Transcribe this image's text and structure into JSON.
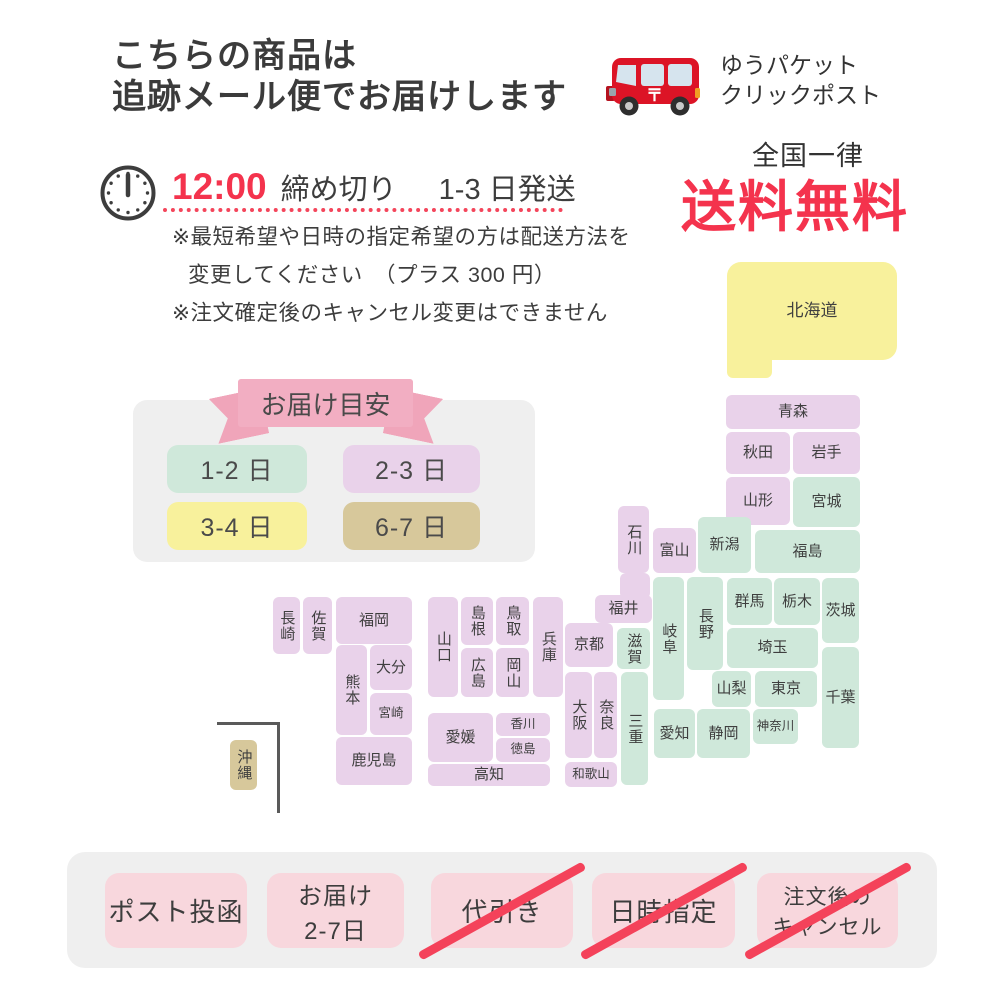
{
  "header": {
    "title_line1": "こちらの商品は",
    "title_line2": "追跡メール便でお届けします",
    "service_line1": "ゆうパケット",
    "service_line2": "クリックポスト",
    "nationwide": "全国一律",
    "free_shipping": "送料無料",
    "accent_red": "#f4334d"
  },
  "deadline": {
    "time": "12:00",
    "label": "締め切り",
    "ship": "1-3 日発送",
    "note1": "※最短希望や日時の指定希望の方は配送方法を",
    "note2": "変更してください　（プラス 300 円）",
    "note3": "※注文確定後のキャンセル変更はできません"
  },
  "legend": {
    "title": "お届け目安",
    "items": [
      {
        "label": "1-2 日",
        "color": "#cfe8da"
      },
      {
        "label": "2-3 日",
        "color": "#e9d2ea"
      },
      {
        "label": "3-4 日",
        "color": "#f8f19c"
      },
      {
        "label": "6-7 日",
        "color": "#d7c89b"
      }
    ]
  },
  "map": {
    "palette": {
      "green": "#cfe8da",
      "purple": "#e9d2ea",
      "yellow": "#f8f19c",
      "tan": "#d7c89b"
    },
    "prefectures": [
      {
        "id": "hokkaido",
        "name": "北海道",
        "days": "3-4",
        "color": "yellow",
        "x": 727,
        "y": 262,
        "w": 170,
        "h": 98,
        "big": true
      },
      {
        "id": "aomori",
        "name": "青森",
        "days": "2-3",
        "color": "purple",
        "x": 726,
        "y": 395,
        "w": 134,
        "h": 34
      },
      {
        "id": "akita",
        "name": "秋田",
        "days": "2-3",
        "color": "purple",
        "x": 726,
        "y": 432,
        "w": 64,
        "h": 42
      },
      {
        "id": "iwate",
        "name": "岩手",
        "days": "2-3",
        "color": "purple",
        "x": 793,
        "y": 432,
        "w": 67,
        "h": 42
      },
      {
        "id": "yamagata",
        "name": "山形",
        "days": "2-3",
        "color": "purple",
        "x": 726,
        "y": 477,
        "w": 64,
        "h": 48
      },
      {
        "id": "miyagi",
        "name": "宮城",
        "days": "1-2",
        "color": "green",
        "x": 793,
        "y": 477,
        "w": 67,
        "h": 50
      },
      {
        "id": "niigata",
        "name": "新潟",
        "days": "1-2",
        "color": "green",
        "x": 698,
        "y": 517,
        "w": 53,
        "h": 56
      },
      {
        "id": "fukushima",
        "name": "福島",
        "days": "1-2",
        "color": "green",
        "x": 755,
        "y": 530,
        "w": 105,
        "h": 43
      },
      {
        "id": "ishikawa",
        "name": "石川",
        "days": "2-3",
        "color": "purple",
        "x": 618,
        "y": 506,
        "w": 31,
        "h": 67,
        "vertical": true
      },
      {
        "id": "toyama",
        "name": "富山",
        "days": "2-3",
        "color": "purple",
        "x": 653,
        "y": 528,
        "w": 43,
        "h": 45
      },
      {
        "id": "fukui",
        "name": "福井",
        "days": "2-3",
        "color": "purple",
        "x": 595,
        "y": 595,
        "w": 57,
        "h": 28
      },
      {
        "id": "gifu",
        "name": "岐阜",
        "days": "1-2",
        "color": "green",
        "x": 653,
        "y": 577,
        "w": 31,
        "h": 123,
        "vertical": true
      },
      {
        "id": "nagano",
        "name": "長野",
        "days": "1-2",
        "color": "green",
        "x": 687,
        "y": 577,
        "w": 36,
        "h": 93,
        "vertical": true
      },
      {
        "id": "gunma",
        "name": "群馬",
        "days": "1-2",
        "color": "green",
        "x": 727,
        "y": 578,
        "w": 45,
        "h": 47
      },
      {
        "id": "tochigi",
        "name": "栃木",
        "days": "1-2",
        "color": "green",
        "x": 774,
        "y": 578,
        "w": 46,
        "h": 47
      },
      {
        "id": "ibaraki",
        "name": "茨城",
        "days": "1-2",
        "color": "green",
        "x": 822,
        "y": 578,
        "w": 37,
        "h": 65
      },
      {
        "id": "saitama",
        "name": "埼玉",
        "days": "1-2",
        "color": "green",
        "x": 727,
        "y": 628,
        "w": 91,
        "h": 40
      },
      {
        "id": "shiga",
        "name": "滋賀",
        "days": "1-2",
        "color": "green",
        "x": 617,
        "y": 628,
        "w": 33,
        "h": 41,
        "vertical": true
      },
      {
        "id": "kyoto",
        "name": "京都",
        "days": "2-3",
        "color": "purple",
        "x": 565,
        "y": 623,
        "w": 48,
        "h": 44
      },
      {
        "id": "yamanashi",
        "name": "山梨",
        "days": "1-2",
        "color": "green",
        "x": 712,
        "y": 671,
        "w": 39,
        "h": 36
      },
      {
        "id": "tokyo",
        "name": "東京",
        "days": "1-2",
        "color": "green",
        "x": 755,
        "y": 671,
        "w": 62,
        "h": 36
      },
      {
        "id": "chiba",
        "name": "千葉",
        "days": "1-2",
        "color": "green",
        "x": 822,
        "y": 647,
        "w": 37,
        "h": 101
      },
      {
        "id": "kanagawa",
        "name": "神奈川",
        "days": "1-2",
        "color": "green",
        "x": 753,
        "y": 709,
        "w": 45,
        "h": 35,
        "small": true
      },
      {
        "id": "shizuoka",
        "name": "静岡",
        "days": "1-2",
        "color": "green",
        "x": 697,
        "y": 709,
        "w": 53,
        "h": 49
      },
      {
        "id": "aichi",
        "name": "愛知",
        "days": "1-2",
        "color": "green",
        "x": 654,
        "y": 709,
        "w": 41,
        "h": 49
      },
      {
        "id": "mie",
        "name": "三重",
        "days": "1-2",
        "color": "green",
        "x": 621,
        "y": 672,
        "w": 27,
        "h": 113,
        "vertical": true
      },
      {
        "id": "nara",
        "name": "奈良",
        "days": "2-3",
        "color": "purple",
        "x": 594,
        "y": 672,
        "w": 23,
        "h": 86,
        "vertical": true
      },
      {
        "id": "osaka",
        "name": "大阪",
        "days": "2-3",
        "color": "purple",
        "x": 565,
        "y": 672,
        "w": 27,
        "h": 86,
        "vertical": true
      },
      {
        "id": "wakayama",
        "name": "和歌山",
        "days": "2-3",
        "color": "purple",
        "x": 565,
        "y": 762,
        "w": 52,
        "h": 25,
        "small": true
      },
      {
        "id": "hyogo",
        "name": "兵庫",
        "days": "2-3",
        "color": "purple",
        "x": 533,
        "y": 597,
        "w": 30,
        "h": 100,
        "vertical": true
      },
      {
        "id": "tottori",
        "name": "鳥取",
        "days": "2-3",
        "color": "purple",
        "x": 496,
        "y": 597,
        "w": 33,
        "h": 48,
        "vertical": true
      },
      {
        "id": "okayama",
        "name": "岡山",
        "days": "2-3",
        "color": "purple",
        "x": 496,
        "y": 648,
        "w": 33,
        "h": 49,
        "vertical": true
      },
      {
        "id": "shimane",
        "name": "島根",
        "days": "2-3",
        "color": "purple",
        "x": 461,
        "y": 597,
        "w": 32,
        "h": 48,
        "vertical": true
      },
      {
        "id": "hiroshima",
        "name": "広島",
        "days": "2-3",
        "color": "purple",
        "x": 461,
        "y": 648,
        "w": 32,
        "h": 49,
        "vertical": true
      },
      {
        "id": "yamaguchi",
        "name": "山口",
        "days": "2-3",
        "color": "purple",
        "x": 428,
        "y": 597,
        "w": 30,
        "h": 100,
        "vertical": true
      },
      {
        "id": "kagawa",
        "name": "香川",
        "days": "2-3",
        "color": "purple",
        "x": 496,
        "y": 713,
        "w": 54,
        "h": 23,
        "small": true
      },
      {
        "id": "tokushima",
        "name": "徳島",
        "days": "2-3",
        "color": "purple",
        "x": 496,
        "y": 738,
        "w": 54,
        "h": 24,
        "small": true
      },
      {
        "id": "ehime",
        "name": "愛媛",
        "days": "2-3",
        "color": "purple",
        "x": 428,
        "y": 713,
        "w": 65,
        "h": 49
      },
      {
        "id": "kochi",
        "name": "高知",
        "days": "2-3",
        "color": "purple",
        "x": 428,
        "y": 764,
        "w": 122,
        "h": 22
      },
      {
        "id": "fukuoka",
        "name": "福岡",
        "days": "2-3",
        "color": "purple",
        "x": 336,
        "y": 597,
        "w": 76,
        "h": 47
      },
      {
        "id": "oita",
        "name": "大分",
        "days": "2-3",
        "color": "purple",
        "x": 370,
        "y": 645,
        "w": 42,
        "h": 45
      },
      {
        "id": "miyazaki",
        "name": "宮崎",
        "days": "2-3",
        "color": "purple",
        "x": 370,
        "y": 693,
        "w": 42,
        "h": 42,
        "small": true
      },
      {
        "id": "kumamoto",
        "name": "熊本",
        "days": "2-3",
        "color": "purple",
        "x": 336,
        "y": 645,
        "w": 31,
        "h": 90,
        "vertical": true
      },
      {
        "id": "kagoshima",
        "name": "鹿児島",
        "days": "2-3",
        "color": "purple",
        "x": 336,
        "y": 737,
        "w": 76,
        "h": 48
      },
      {
        "id": "saga",
        "name": "佐賀",
        "days": "2-3",
        "color": "purple",
        "x": 303,
        "y": 597,
        "w": 29,
        "h": 57,
        "vertical": true
      },
      {
        "id": "nagasaki",
        "name": "長崎",
        "days": "2-3",
        "color": "purple",
        "x": 273,
        "y": 597,
        "w": 27,
        "h": 57,
        "vertical": true
      },
      {
        "id": "okinawa",
        "name": "沖縄",
        "days": "6-7",
        "color": "tan",
        "x": 230,
        "y": 740,
        "w": 27,
        "h": 50,
        "vertical": true
      }
    ],
    "extras": [
      {
        "id": "hokkaido-tab",
        "color": "yellow",
        "x": 727,
        "y": 338,
        "w": 45,
        "h": 40
      },
      {
        "id": "fukui-tab",
        "color": "purple",
        "x": 620,
        "y": 573,
        "w": 30,
        "h": 26
      }
    ]
  },
  "footer": {
    "badges": [
      {
        "lines": [
          "ポスト投函"
        ],
        "crossed": false
      },
      {
        "lines": [
          "お届け",
          "2-7日"
        ],
        "crossed": false
      },
      {
        "lines": [
          "代引き"
        ],
        "crossed": true
      },
      {
        "lines": [
          "日時指定"
        ],
        "crossed": true
      },
      {
        "lines": [
          "注文後の",
          "キャンセル"
        ],
        "crossed": true
      }
    ]
  }
}
